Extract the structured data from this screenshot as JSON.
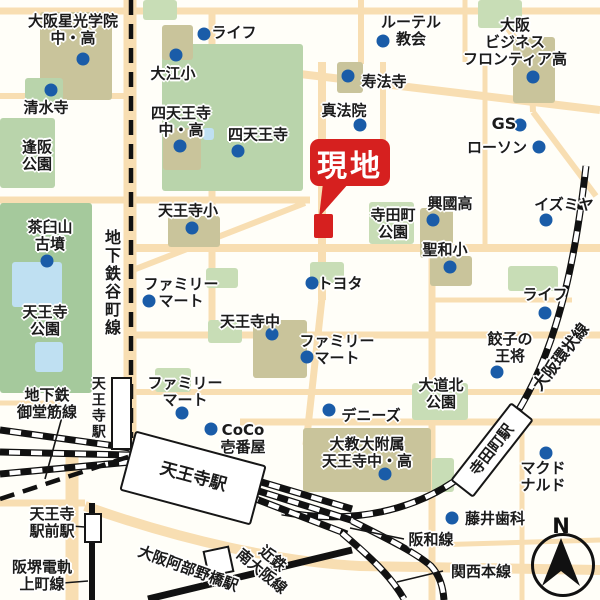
{
  "title": "周辺地図(天王寺エリア)",
  "compass": {
    "label": "N"
  },
  "callout": {
    "text": "現地",
    "color": "#d6201f",
    "box": {
      "x": 310,
      "y": 139,
      "w": 80,
      "h": 47
    },
    "tail": "323,183 349,183 319,217",
    "marker": {
      "x": 314,
      "y": 214,
      "w": 19,
      "h": 24
    }
  },
  "colors": {
    "background": "#fffef8",
    "road": "#f8deb2",
    "park": "#a5c99c",
    "green": "#b9d4ab",
    "lightgreen": "#c8ddb6",
    "school": "#c9c49b",
    "pond": "#bfe0f2",
    "rail": "#111111",
    "dot": "#1a5ca8",
    "site_red": "#d6201f"
  },
  "labels": [
    {
      "id": "osaka-seiko-gakuin",
      "lines": [
        "大阪星光学院",
        "中・高"
      ],
      "x": 73,
      "y": 30,
      "dot": {
        "x": 83,
        "y": 59
      }
    },
    {
      "id": "life-north",
      "lines": [
        "ライフ"
      ],
      "x": 234,
      "y": 33,
      "dot": {
        "x": 204,
        "y": 34
      }
    },
    {
      "id": "oe-elementary",
      "lines": [
        "大江小"
      ],
      "x": 173,
      "y": 74,
      "dot": {
        "x": 176,
        "y": 55
      }
    },
    {
      "id": "lutheran-church",
      "lines": [
        "ルーテル",
        "教会"
      ],
      "x": 411,
      "y": 31,
      "dot": {
        "x": 383,
        "y": 41
      }
    },
    {
      "id": "osaka-business-frontier-high",
      "lines": [
        "大阪",
        "ビジネス",
        "フロンティア高"
      ],
      "x": 515,
      "y": 42,
      "dot": {
        "x": 533,
        "y": 77
      }
    },
    {
      "id": "shimizu-temple",
      "lines": [
        "清水寺"
      ],
      "x": 46,
      "y": 108,
      "dot": {
        "x": 51,
        "y": 90
      }
    },
    {
      "id": "shitennoji-jhs",
      "lines": [
        "四天王寺",
        "中・高"
      ],
      "x": 181,
      "y": 122,
      "dot": {
        "x": 180,
        "y": 146
      }
    },
    {
      "id": "shitennoji",
      "lines": [
        "四天王寺"
      ],
      "x": 258,
      "y": 135,
      "dot": {
        "x": 238,
        "y": 151
      }
    },
    {
      "id": "juhoji",
      "lines": [
        "寿法寺"
      ],
      "x": 384,
      "y": 82,
      "dot": {
        "x": 348,
        "y": 76
      }
    },
    {
      "id": "shinhoin",
      "lines": [
        "真法院"
      ],
      "x": 344,
      "y": 111,
      "dot": {
        "x": 360,
        "y": 125
      }
    },
    {
      "id": "gs",
      "lines": [
        "GS"
      ],
      "x": 504,
      "y": 124,
      "fs": 16,
      "dot": {
        "x": 520,
        "y": 125
      }
    },
    {
      "id": "lawson",
      "lines": [
        "ローソン"
      ],
      "x": 497,
      "y": 148,
      "dot": {
        "x": 539,
        "y": 147
      }
    },
    {
      "id": "izumiya",
      "lines": [
        "イズミヤ"
      ],
      "x": 564,
      "y": 205,
      "dot": {
        "x": 546,
        "y": 220
      }
    },
    {
      "id": "osaka-park",
      "lines": [
        "逢阪",
        "公園"
      ],
      "x": 37,
      "y": 156
    },
    {
      "id": "chausuyama-kofun",
      "lines": [
        "茶臼山",
        "古墳"
      ],
      "x": 50,
      "y": 236,
      "dot": {
        "x": 47,
        "y": 261
      }
    },
    {
      "id": "tanimachi-subway-line",
      "lines": [
        "地下鉄谷町線"
      ],
      "x": 111,
      "y": 283,
      "vertical": true,
      "fs": 16
    },
    {
      "id": "tennoji-elementary",
      "lines": [
        "天王寺小"
      ],
      "x": 188,
      "y": 211,
      "dot": {
        "x": 192,
        "y": 228
      }
    },
    {
      "id": "teradacho-park",
      "lines": [
        "寺田町",
        "公園"
      ],
      "x": 393,
      "y": 224
    },
    {
      "id": "kokoku-high",
      "lines": [
        "興國高"
      ],
      "x": 450,
      "y": 204,
      "dot": {
        "x": 433,
        "y": 220
      }
    },
    {
      "id": "seiwa-elementary",
      "lines": [
        "聖和小"
      ],
      "x": 445,
      "y": 250,
      "dot": {
        "x": 450,
        "y": 267
      }
    },
    {
      "id": "tennoji-park",
      "lines": [
        "天王寺",
        "公園"
      ],
      "x": 45,
      "y": 321
    },
    {
      "id": "familymart-west",
      "lines": [
        "ファミリー",
        "マート"
      ],
      "x": 181,
      "y": 293,
      "dot": {
        "x": 149,
        "y": 301
      }
    },
    {
      "id": "toyota",
      "lines": [
        "トヨタ"
      ],
      "x": 340,
      "y": 284,
      "dot": {
        "x": 312,
        "y": 283
      }
    },
    {
      "id": "tennoji-jhs",
      "lines": [
        "天王寺中"
      ],
      "x": 250,
      "y": 322,
      "dot": {
        "x": 272,
        "y": 334
      }
    },
    {
      "id": "life-east",
      "lines": [
        "ライフ"
      ],
      "x": 545,
      "y": 295,
      "dot": {
        "x": 545,
        "y": 313
      }
    },
    {
      "id": "familymart-center",
      "lines": [
        "ファミリー",
        "マート"
      ],
      "x": 337,
      "y": 350,
      "dot": {
        "x": 307,
        "y": 357
      }
    },
    {
      "id": "gyoza-no-ohsho",
      "lines": [
        "餃子の",
        "王将"
      ],
      "x": 510,
      "y": 348,
      "dot": {
        "x": 497,
        "y": 372
      }
    },
    {
      "id": "midosuji-subway-line",
      "lines": [
        "地下鉄",
        "御堂筋線"
      ],
      "x": 47,
      "y": 404
    },
    {
      "id": "familymart-south",
      "lines": [
        "ファミリー",
        "マート"
      ],
      "x": 185,
      "y": 392,
      "dot": {
        "x": 182,
        "y": 413
      }
    },
    {
      "id": "daido-kita-park",
      "lines": [
        "大道北",
        "公園"
      ],
      "x": 441,
      "y": 394
    },
    {
      "id": "dennys",
      "lines": [
        "デニーズ"
      ],
      "x": 371,
      "y": 416,
      "dot": {
        "x": 329,
        "y": 410
      }
    },
    {
      "id": "coco-ichibanya",
      "lines": [
        "CoCo",
        "壱番屋"
      ],
      "x": 243,
      "y": 439,
      "dot": {
        "x": 211,
        "y": 429
      }
    },
    {
      "id": "tennoji-subway-station",
      "lines": [
        "天王寺駅"
      ],
      "x": 97,
      "y": 408,
      "vertical": true,
      "fs": 14
    },
    {
      "id": "tennoji-jr-station",
      "lines": [
        "天王寺駅"
      ],
      "x": 193,
      "y": 478,
      "rot": 15,
      "fs": 17,
      "plate": {
        "w": 132,
        "h": 58
      }
    },
    {
      "id": "daikyodai-fuzoku-tennoji",
      "lines": [
        "大教大附属",
        "天王寺中・高"
      ],
      "x": 367,
      "y": 453,
      "dot": {
        "x": 385,
        "y": 474
      }
    },
    {
      "id": "teradacho-station",
      "lines": [
        "寺田町駅"
      ],
      "x": 492,
      "y": 450,
      "rot": -52,
      "fs": 15,
      "plate": {
        "w": 95,
        "h": 25
      }
    },
    {
      "id": "osaka-loop-line",
      "lines": [
        "大阪環状線"
      ],
      "x": 561,
      "y": 357,
      "rot": -52,
      "fs": 16
    },
    {
      "id": "mcdonalds",
      "lines": [
        "マクド",
        "ナルド"
      ],
      "x": 543,
      "y": 477,
      "dot": {
        "x": 546,
        "y": 453
      }
    },
    {
      "id": "tennoji-ekimae-station",
      "lines": [
        "天王寺",
        "駅前駅"
      ],
      "x": 52,
      "y": 523
    },
    {
      "id": "fujii-dental",
      "lines": [
        "藤井歯科"
      ],
      "x": 495,
      "y": 519,
      "dot": {
        "x": 452,
        "y": 518
      }
    },
    {
      "id": "hankai-uemachi-line",
      "lines": [
        "阪堺電軌",
        "上町線"
      ],
      "x": 42,
      "y": 576
    },
    {
      "id": "hanwa-line",
      "lines": [
        "阪和線"
      ],
      "x": 431,
      "y": 540
    },
    {
      "id": "kintetsu-abenobashi-station",
      "lines": [
        "大阪阿部野橋駅"
      ],
      "x": 188,
      "y": 569,
      "rot": 20,
      "fs": 15
    },
    {
      "id": "kintetsu-minami-osaka-line",
      "lines": [
        "近鉄",
        "南大阪線"
      ],
      "x": 267,
      "y": 565,
      "rot": 40,
      "fs": 15
    },
    {
      "id": "kansai-main-line",
      "lines": [
        "関西本線"
      ],
      "x": 481,
      "y": 572
    }
  ],
  "geometry": {
    "roads": [
      {
        "d": "M 0,11 H 600",
        "w": 7
      },
      {
        "d": "M 57,8 V 98",
        "w": 5
      },
      {
        "d": "M 0,96 H 131",
        "w": 6
      },
      {
        "d": "M 130,0 V 440",
        "w": 13
      },
      {
        "d": "M 212,10 V 338",
        "w": 7
      },
      {
        "d": "M 361,0 V 64",
        "w": 6
      },
      {
        "d": "M 465,0 V 62",
        "w": 5
      },
      {
        "d": "M 487,0 L 531,60 L 533,112",
        "w": 6
      },
      {
        "d": "M 533,112 L 596,196",
        "w": 6
      },
      {
        "d": "M 485,62 V 250",
        "w": 5
      },
      {
        "d": "M 250,68 L 600,110",
        "w": 8
      },
      {
        "d": "M 383,62 V 140",
        "w": 6
      },
      {
        "d": "M 0,200 H 310",
        "w": 7
      },
      {
        "d": "M 128,272 L 305,203",
        "w": 6
      },
      {
        "d": "M 130,248 H 600",
        "w": 8
      },
      {
        "d": "M 322,62 V 300",
        "w": 8
      },
      {
        "d": "M 322,298 L 306,445",
        "w": 7
      },
      {
        "d": "M 130,335 H 600",
        "w": 7
      },
      {
        "d": "M 130,392 H 600",
        "w": 6
      },
      {
        "d": "M 240,422 H 600",
        "w": 7
      },
      {
        "d": "M 432,250 V 600",
        "w": 7
      },
      {
        "d": "M 522,428 V 600",
        "w": 5
      },
      {
        "d": "M 430,300 H 572",
        "w": 5
      },
      {
        "d": "M 0,403 H 60",
        "w": 5
      },
      {
        "d": "M 0,503 H 85",
        "w": 7
      },
      {
        "d": "M 72,455 V 600",
        "w": 13
      },
      {
        "d": "M 85,506 C 180,540 280,562 360,566 L 600,570",
        "w": 10
      },
      {
        "d": "M 432,545 L 600,540",
        "w": 5
      }
    ],
    "areas": [
      {
        "name": "green-top",
        "kind": "lightgreen",
        "x": 143,
        "y": 0,
        "w": 34,
        "h": 20
      },
      {
        "name": "green-top-right",
        "kind": "lightgreen",
        "x": 478,
        "y": 0,
        "w": 44,
        "h": 28
      },
      {
        "name": "seiko-gakuin-grounds",
        "kind": "school",
        "x": 40,
        "y": 12,
        "w": 72,
        "h": 88
      },
      {
        "name": "shimizu-temple-grounds",
        "kind": "green",
        "x": 25,
        "y": 78,
        "w": 38,
        "h": 28
      },
      {
        "name": "osaka-park-area",
        "kind": "green",
        "x": 0,
        "y": 118,
        "w": 55,
        "h": 70
      },
      {
        "name": "shitennoji-grounds",
        "kind": "green",
        "x": 162,
        "y": 44,
        "w": 141,
        "h": 147
      },
      {
        "name": "shitennoji-pond",
        "kind": "pond",
        "x": 203,
        "y": 128,
        "w": 11,
        "h": 12
      },
      {
        "name": "oe-elementary-grounds",
        "kind": "school",
        "x": 162,
        "y": 25,
        "w": 31,
        "h": 35
      },
      {
        "name": "shitennoji-jhs-grounds",
        "kind": "school",
        "x": 163,
        "y": 128,
        "w": 38,
        "h": 42
      },
      {
        "name": "juhoji-grounds",
        "kind": "school",
        "x": 337,
        "y": 62,
        "w": 26,
        "h": 31
      },
      {
        "name": "obf-high-grounds",
        "kind": "school",
        "x": 513,
        "y": 37,
        "w": 42,
        "h": 66
      },
      {
        "name": "tennoji-park-area",
        "kind": "park",
        "x": 0,
        "y": 203,
        "w": 92,
        "h": 190
      },
      {
        "name": "tennoji-park-pond1",
        "kind": "pond",
        "x": 12,
        "y": 262,
        "w": 50,
        "h": 45
      },
      {
        "name": "tennoji-park-pond2",
        "kind": "pond",
        "x": 35,
        "y": 342,
        "w": 28,
        "h": 30
      },
      {
        "name": "tennoji-elementary-grounds",
        "kind": "school",
        "x": 168,
        "y": 216,
        "w": 52,
        "h": 31
      },
      {
        "name": "teradacho-park-area",
        "kind": "lightgreen",
        "x": 369,
        "y": 202,
        "w": 45,
        "h": 42
      },
      {
        "name": "kokoku-high-grounds",
        "kind": "school",
        "x": 420,
        "y": 208,
        "w": 33,
        "h": 50
      },
      {
        "name": "seiwa-elementary-grounds",
        "kind": "school",
        "x": 430,
        "y": 256,
        "w": 42,
        "h": 30
      },
      {
        "name": "green-toyota",
        "kind": "lightgreen",
        "x": 310,
        "y": 262,
        "w": 34,
        "h": 21
      },
      {
        "name": "green-center-1",
        "kind": "lightgreen",
        "x": 206,
        "y": 268,
        "w": 32,
        "h": 20
      },
      {
        "name": "green-center-2",
        "kind": "lightgreen",
        "x": 208,
        "y": 320,
        "w": 34,
        "h": 23
      },
      {
        "name": "tennoji-jhs-grounds",
        "kind": "school",
        "x": 253,
        "y": 320,
        "w": 54,
        "h": 58
      },
      {
        "name": "green-life-east",
        "kind": "lightgreen",
        "x": 508,
        "y": 266,
        "w": 50,
        "h": 25
      },
      {
        "name": "daido-kita-park-area",
        "kind": "lightgreen",
        "x": 412,
        "y": 383,
        "w": 56,
        "h": 37
      },
      {
        "name": "green-familymart-south",
        "kind": "lightgreen",
        "x": 155,
        "y": 368,
        "w": 36,
        "h": 24
      },
      {
        "name": "daikyodai-grounds",
        "kind": "school",
        "x": 303,
        "y": 428,
        "w": 128,
        "h": 64
      },
      {
        "name": "green-daikyo-east",
        "kind": "lightgreen",
        "x": 432,
        "y": 458,
        "w": 22,
        "h": 34
      }
    ],
    "rails": [
      {
        "name": "jr-west-track-1",
        "style": "jr",
        "d": "M 130,448 L 0,430"
      },
      {
        "name": "jr-west-track-2",
        "style": "jr",
        "d": "M 130,455 L 0,452"
      },
      {
        "name": "jr-west-track-3",
        "style": "jr",
        "d": "M 130,462 L 0,474"
      },
      {
        "name": "osaka-loop-line",
        "style": "jr",
        "d": "M 586,166 C 574,272 552,388 480,460 C 438,502 368,528 282,512"
      },
      {
        "name": "jr-east-track-1",
        "style": "jr",
        "d": "M 248,478 L 352,509"
      },
      {
        "name": "jr-east-track-2",
        "style": "jr",
        "d": "M 246,487 L 354,521"
      },
      {
        "name": "jr-east-track-3",
        "style": "jr",
        "d": "M 248,496 L 347,534"
      },
      {
        "name": "hanwa-line",
        "style": "jr",
        "d": "M 352,521 C 392,541 416,553 431,566 C 440,576 443,587 444,600"
      },
      {
        "name": "kansai-main-line",
        "style": "jr",
        "d": "M 342,533 C 370,557 390,575 404,599"
      },
      {
        "name": "kintetsu-minami-osaka-line",
        "style": "solid",
        "w": 7,
        "d": "M 148,599 L 352,550"
      },
      {
        "name": "hankai-uemachi-line",
        "style": "solid",
        "w": 6,
        "d": "M 92,503 L 92,600"
      },
      {
        "name": "tanimachi-subway-line",
        "style": "dashed",
        "d": "M 131,0 L 131,438"
      },
      {
        "name": "midosuji-subway-line",
        "style": "dashed",
        "d": "M 0,499 L 146,451"
      }
    ],
    "leaders": [
      {
        "name": "leader-midosuji",
        "x1": 62,
        "y1": 417,
        "x2": 45,
        "y2": 479
      },
      {
        "name": "leader-ekimae",
        "x1": 71,
        "y1": 526,
        "x2": 85,
        "y2": 527
      },
      {
        "name": "leader-hankai",
        "x1": 63,
        "y1": 583,
        "x2": 88,
        "y2": 581
      },
      {
        "name": "leader-hanwa",
        "x1": 404,
        "y1": 539,
        "x2": 350,
        "y2": 528
      },
      {
        "name": "leader-kansai",
        "x1": 443,
        "y1": 571,
        "x2": 397,
        "y2": 582
      }
    ],
    "stations": [
      {
        "name": "tennoji-subway-station-box",
        "x": 111,
        "y": 377,
        "w": 17,
        "h": 69
      },
      {
        "name": "tennoji-ekimae-station-box",
        "x": 84,
        "y": 513,
        "w": 14,
        "h": 26
      },
      {
        "name": "kintetsu-abenobashi-station-box",
        "x": 205,
        "y": 548,
        "w": 23,
        "h": 23,
        "rot": -12
      }
    ]
  }
}
